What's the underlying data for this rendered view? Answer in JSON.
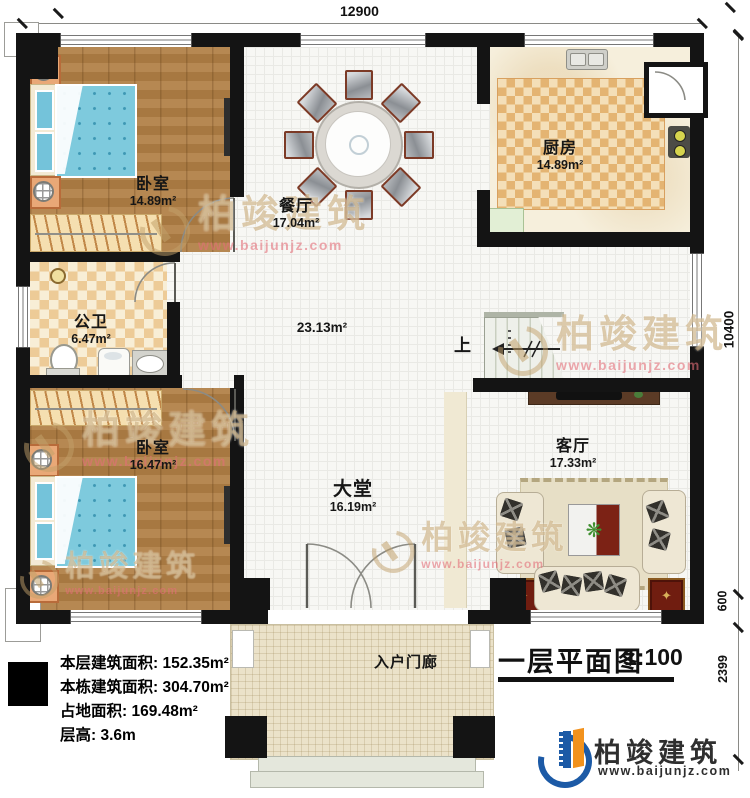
{
  "dims": {
    "top": "12900",
    "right_main": "10400",
    "right_step": "600",
    "right_porch": "2399"
  },
  "rooms": {
    "bedroom1": {
      "name": "卧室",
      "area": "14.89m²"
    },
    "dining": {
      "name": "餐厅",
      "area": "17.04m²"
    },
    "kitchen": {
      "name": "厨房",
      "area": "14.89m²"
    },
    "bathroom": {
      "name": "公卫",
      "area": "6.47m²"
    },
    "bedroom2": {
      "name": "卧室",
      "area": "16.47m²"
    },
    "hall": {
      "area": "23.13m²"
    },
    "lobby": {
      "name": "大堂",
      "area": "16.19m²"
    },
    "living": {
      "name": "客厅",
      "area": "17.33m²"
    },
    "porch": {
      "name": "入户门廊"
    }
  },
  "stairs": {
    "up_label": "上"
  },
  "info": {
    "rows": [
      {
        "label": "本层建筑面积: ",
        "value": "152.35m²"
      },
      {
        "label": "本栋建筑面积: ",
        "value": "304.70m²"
      },
      {
        "label": "占地面积: ",
        "value": "169.48m²"
      },
      {
        "label": "层高: ",
        "value": "3.6m"
      }
    ]
  },
  "title": {
    "text": "一层平面图",
    "scale": "1:100"
  },
  "brand": {
    "name": "柏竣建筑",
    "url": "www.baijunjz.com"
  },
  "watermark": {
    "name": "柏竣建筑",
    "url": "www.baijunjz.com"
  },
  "icons": {
    "plant": "❋",
    "compass": "✦"
  },
  "colors": {
    "wall": "#141414",
    "brand_blue": "#1c5aa6",
    "brand_orange": "#f2921d",
    "mat_red": "#701d10"
  }
}
